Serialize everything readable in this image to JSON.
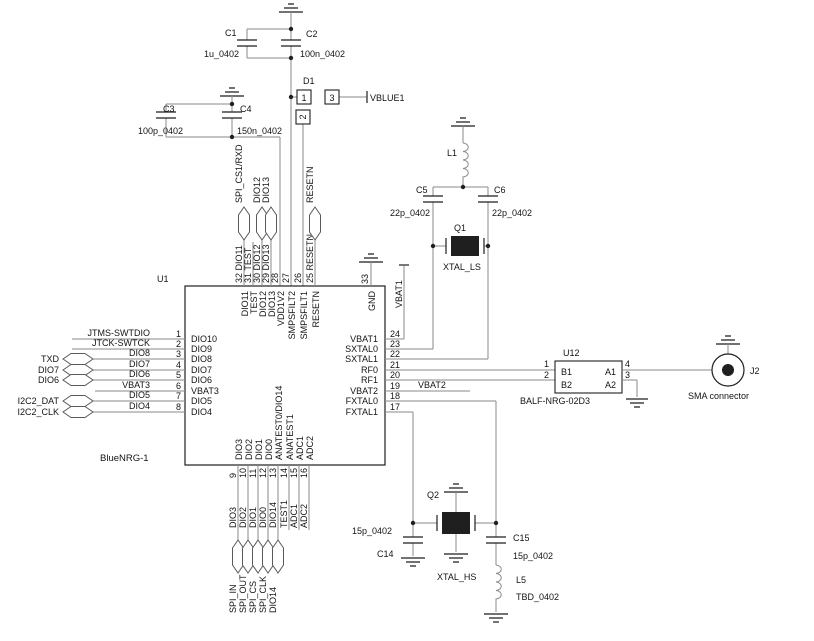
{
  "u1": {
    "ref": "U1",
    "part": "BlueNRG-1",
    "gnd_pin": {
      "num": "33",
      "inner": "GND"
    },
    "left": [
      {
        "num": "1",
        "inner": "DIO10",
        "wire": "JTMS-SWTDIO",
        "port": ""
      },
      {
        "num": "2",
        "inner": "DIO9",
        "wire": "JTCK-SWTCK",
        "port": ""
      },
      {
        "num": "3",
        "inner": "DIO8",
        "wire": "DIO8",
        "port": "TXD"
      },
      {
        "num": "4",
        "inner": "DIO7",
        "wire": "DIO7",
        "port": "DIO7"
      },
      {
        "num": "5",
        "inner": "DIO6",
        "wire": "DIO6",
        "port": "DIO6"
      },
      {
        "num": "6",
        "inner": "VBAT3",
        "wire": "VBAT3",
        "port": ""
      },
      {
        "num": "7",
        "inner": "DIO5",
        "wire": "DIO5",
        "port": "I2C2_DAT"
      },
      {
        "num": "8",
        "inner": "DIO4",
        "wire": "DIO4",
        "port": "I2C2_CLK"
      }
    ],
    "top": [
      {
        "stub": "32 DIO11",
        "inner": "DIO11",
        "port": "SPI_CS1/RXD"
      },
      {
        "stub": "31 TEST",
        "inner": "TEST",
        "port": ""
      },
      {
        "stub": "30 DIO12",
        "inner": "DIO12",
        "port": "DIO12"
      },
      {
        "stub": "29 DIO13",
        "inner": "DIO13",
        "port": "DIO13"
      },
      {
        "stub": "28",
        "inner": "VDD1V2",
        "port": ""
      },
      {
        "stub": "27",
        "inner": "SMPSFILT2",
        "port": ""
      },
      {
        "stub": "26",
        "inner": "SMPSFILT1",
        "port": ""
      },
      {
        "stub": "25 RESETN",
        "inner": "RESETN",
        "port": "RESETN"
      }
    ],
    "right": [
      {
        "num": "24",
        "inner": "VBAT1"
      },
      {
        "num": "23",
        "inner": "SXTAL0"
      },
      {
        "num": "22",
        "inner": "SXTAL1"
      },
      {
        "num": "21",
        "inner": "RF0"
      },
      {
        "num": "20",
        "inner": "RF1"
      },
      {
        "num": "19",
        "inner": "VBAT2"
      },
      {
        "num": "18",
        "inner": "FXTAL0"
      },
      {
        "num": "17",
        "inner": "FXTAL1"
      }
    ],
    "bottom": [
      {
        "num": "9",
        "inner": "DIO3",
        "wire": "DIO3",
        "port": "SPI_IN"
      },
      {
        "num": "10",
        "inner": "DIO2",
        "wire": "DIO2",
        "port": "SPI_OUT"
      },
      {
        "num": "11",
        "inner": "DIO1",
        "wire": "DIO1",
        "port": "SPI_CS"
      },
      {
        "num": "12",
        "inner": "DIO0",
        "wire": "DIO0",
        "port": "SPI_CLK"
      },
      {
        "num": "13",
        "inner": "ANATEST0/DIO14",
        "wire": "DIO14",
        "port": "DIO14"
      },
      {
        "num": "14",
        "inner": "ANATEST1",
        "wire": "TEST1",
        "port": ""
      },
      {
        "num": "15",
        "inner": "ADC1",
        "wire": "ADC1",
        "port": ""
      },
      {
        "num": "16",
        "inner": "ADC2",
        "wire": "ADC2",
        "port": ""
      }
    ]
  },
  "components": {
    "c1": {
      "ref": "C1",
      "value": "1u_0402"
    },
    "c2": {
      "ref": "C2",
      "value": "100n_0402"
    },
    "c3": {
      "ref": "C3",
      "value": "100p_0402"
    },
    "c4": {
      "ref": "C4",
      "value": "150n_0402"
    },
    "d1": {
      "ref": "D1",
      "pin1": "1",
      "pin2": "2",
      "pin3": "3"
    },
    "l1": {
      "ref": "L1"
    },
    "c5": {
      "ref": "C5",
      "value": "22p_0402"
    },
    "c6": {
      "ref": "C6",
      "value": "22p_0402"
    },
    "q1": {
      "ref": "Q1",
      "label": "XTAL_LS"
    },
    "u12": {
      "ref": "U12",
      "part": "BALF-NRG-02D3",
      "pin1": "1",
      "pin2": "2",
      "pin3": "3",
      "pin4": "4",
      "b1": "B1",
      "b2": "B2",
      "a1": "A1",
      "a2": "A2"
    },
    "j2": {
      "ref": "J2",
      "label": "SMA connector"
    },
    "q2": {
      "ref": "Q2",
      "label": "XTAL_HS"
    },
    "c14": {
      "ref": "C14",
      "value": "15p_0402"
    },
    "c15": {
      "ref": "C15",
      "value": "15p_0402"
    },
    "l5": {
      "ref": "L5",
      "value": "TBD_0402"
    }
  },
  "nets": {
    "vblue": "VBLUE1",
    "vbat1": "VBAT1",
    "vbat2": "VBAT2"
  }
}
